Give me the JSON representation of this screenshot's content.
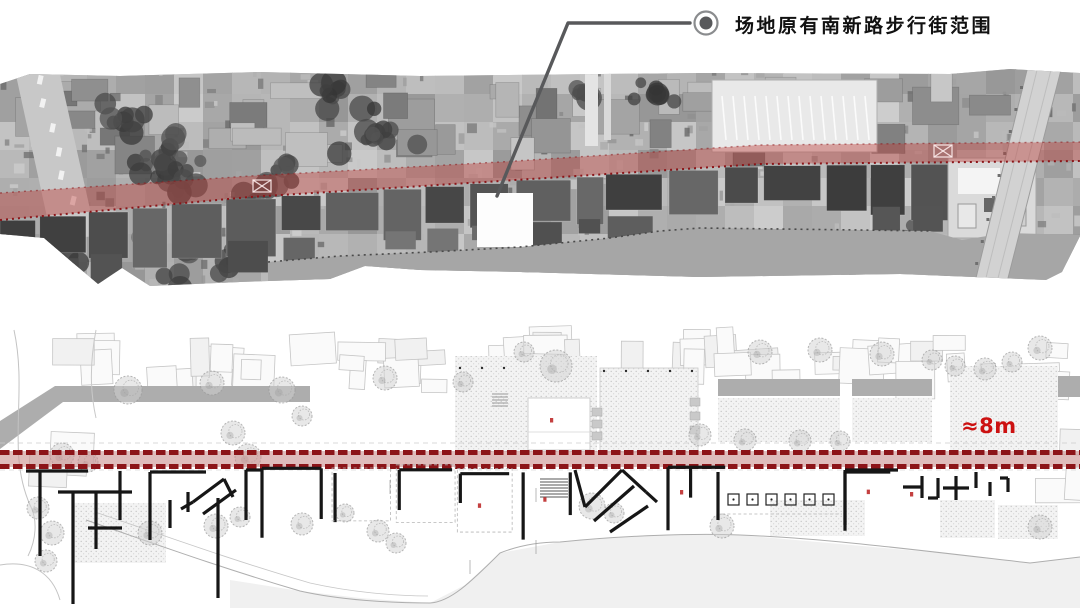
{
  "callout": {
    "label": "场地原有南新路步行街范围",
    "icon": "target-bullet-icon"
  },
  "plan": {
    "corridor_width_label": "≈8m"
  },
  "colors": {
    "highlight_overlay": "#bd3b36",
    "highlight_edge": "#8c1418",
    "corridor_fill": "#c98f8e",
    "corridor_dash": "#8c1418",
    "corridor_label": "#cc1111",
    "leader": "#58595b",
    "ink": "#161616"
  }
}
